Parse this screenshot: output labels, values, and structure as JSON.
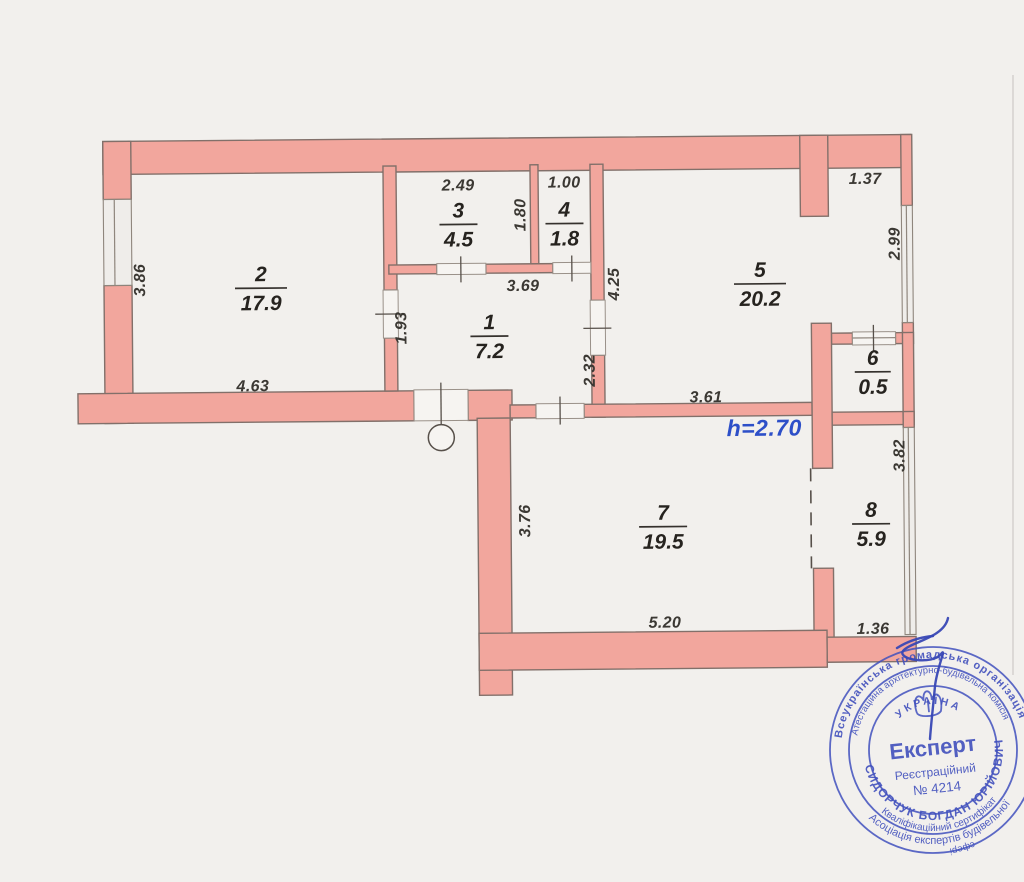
{
  "plan": {
    "height_label": "h=2.70",
    "rooms": [
      {
        "number": "1",
        "area": "7.2"
      },
      {
        "number": "2",
        "area": "17.9"
      },
      {
        "number": "3",
        "area": "4.5"
      },
      {
        "number": "4",
        "area": "1.8"
      },
      {
        "number": "5",
        "area": "20.2"
      },
      {
        "number": "6",
        "area": "0.5"
      },
      {
        "number": "7",
        "area": "19.5"
      },
      {
        "number": "8",
        "area": "5.9"
      }
    ],
    "dims": {
      "top_room3": "2.49",
      "top_room4": "1.00",
      "top_right": "1.37",
      "room2_left": "3.86",
      "room3_height": "1.80",
      "room5_height": "4.25",
      "room5_window": "2.99",
      "hall_width": "3.69",
      "room2_door": "1.93",
      "hall_lower": "2.32",
      "room2_width": "4.63",
      "room5_width": "3.61",
      "room7_height": "3.76",
      "room7_width": "5.20",
      "room8_window": "3.82",
      "room8_bottom": "1.36"
    }
  },
  "stamp": {
    "outer_top": "Всеукраїнська громадська організація",
    "mid_top": "Атестаційна архітектурно-будівельна комісія",
    "bottom_outer": "Асоціація експертів будівельної",
    "bottom_mid": "Кваліфікаційний сертифікат",
    "bottom_fragment": "сфері",
    "name": "СИДОРЧУК БОГДАН ЮРІЙОВИЧ",
    "country": "УКРАЇНА",
    "title": "Експерт",
    "reg_label": "Реєстраційний",
    "reg_number": "№ 4214"
  },
  "colors": {
    "wall_fill": "#f2a69d",
    "wall_outline": "#82706a",
    "dim_text": "#3b3833",
    "height_text": "#2d4fc8",
    "stamp_blue": "#4150bd",
    "paper": "#f2f0ed"
  }
}
